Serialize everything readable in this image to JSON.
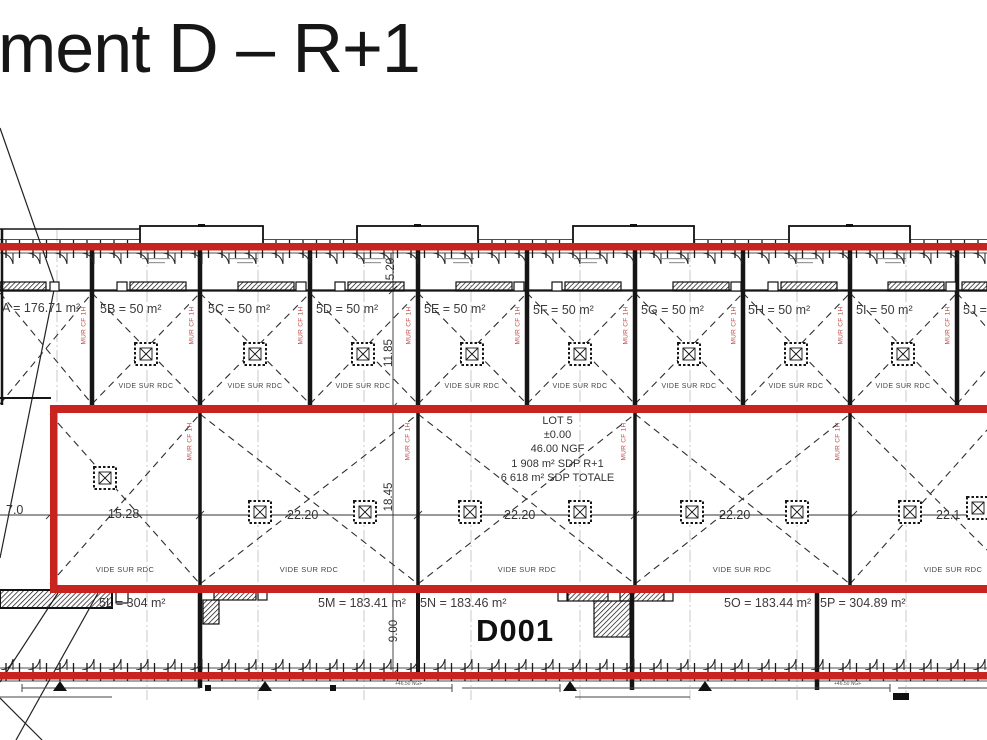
{
  "title": "ment D – R+1",
  "colors": {
    "firewall_red": "#c8241f",
    "mur_text_red": "#bf4a44",
    "ink": "#1a1a1a"
  },
  "plan": {
    "upper_cells": [
      {
        "label": "A = 176.71 m²"
      },
      {
        "label": "5B = 50 m²"
      },
      {
        "label": "5C = 50 m²"
      },
      {
        "label": "5D = 50 m²"
      },
      {
        "label": "5E = 50 m²"
      },
      {
        "label": "5F = 50 m²"
      },
      {
        "label": "5G = 50 m²"
      },
      {
        "label": "5H = 50 m²"
      },
      {
        "label": "5I = 50 m²"
      },
      {
        "label": "5J ="
      }
    ],
    "vide_label": "VIDE SUR RDC",
    "mur_label": "MUR CF 1H",
    "lot_block": {
      "title": "LOT 5",
      "level": "±0.00",
      "ngf": "46.00 NGF",
      "sdp_r1": "1 908 m² SDP R+1",
      "sdp_total": "6 618 m² SDP TOTALE"
    },
    "lower_cells": [
      {
        "label": "5L = 304 m²"
      },
      {
        "label": "5M = 183.41 m²"
      },
      {
        "label": "5N = 183.46 m²"
      },
      {
        "label": "5O = 183.44 m²"
      },
      {
        "label": "5P = 304.89 m²"
      }
    ],
    "door_code": "D001",
    "h_dims": [
      {
        "v": "7.0"
      },
      {
        "v": "15.28"
      },
      {
        "v": "22.20"
      },
      {
        "v": "22.20"
      },
      {
        "v": "22.20"
      },
      {
        "v": "22.1"
      }
    ],
    "v_dims": [
      {
        "v": "5.20"
      },
      {
        "v": "11.85"
      },
      {
        "v": "18.45"
      },
      {
        "v": "9.00"
      }
    ],
    "level_note": "+46.50 NGF"
  }
}
